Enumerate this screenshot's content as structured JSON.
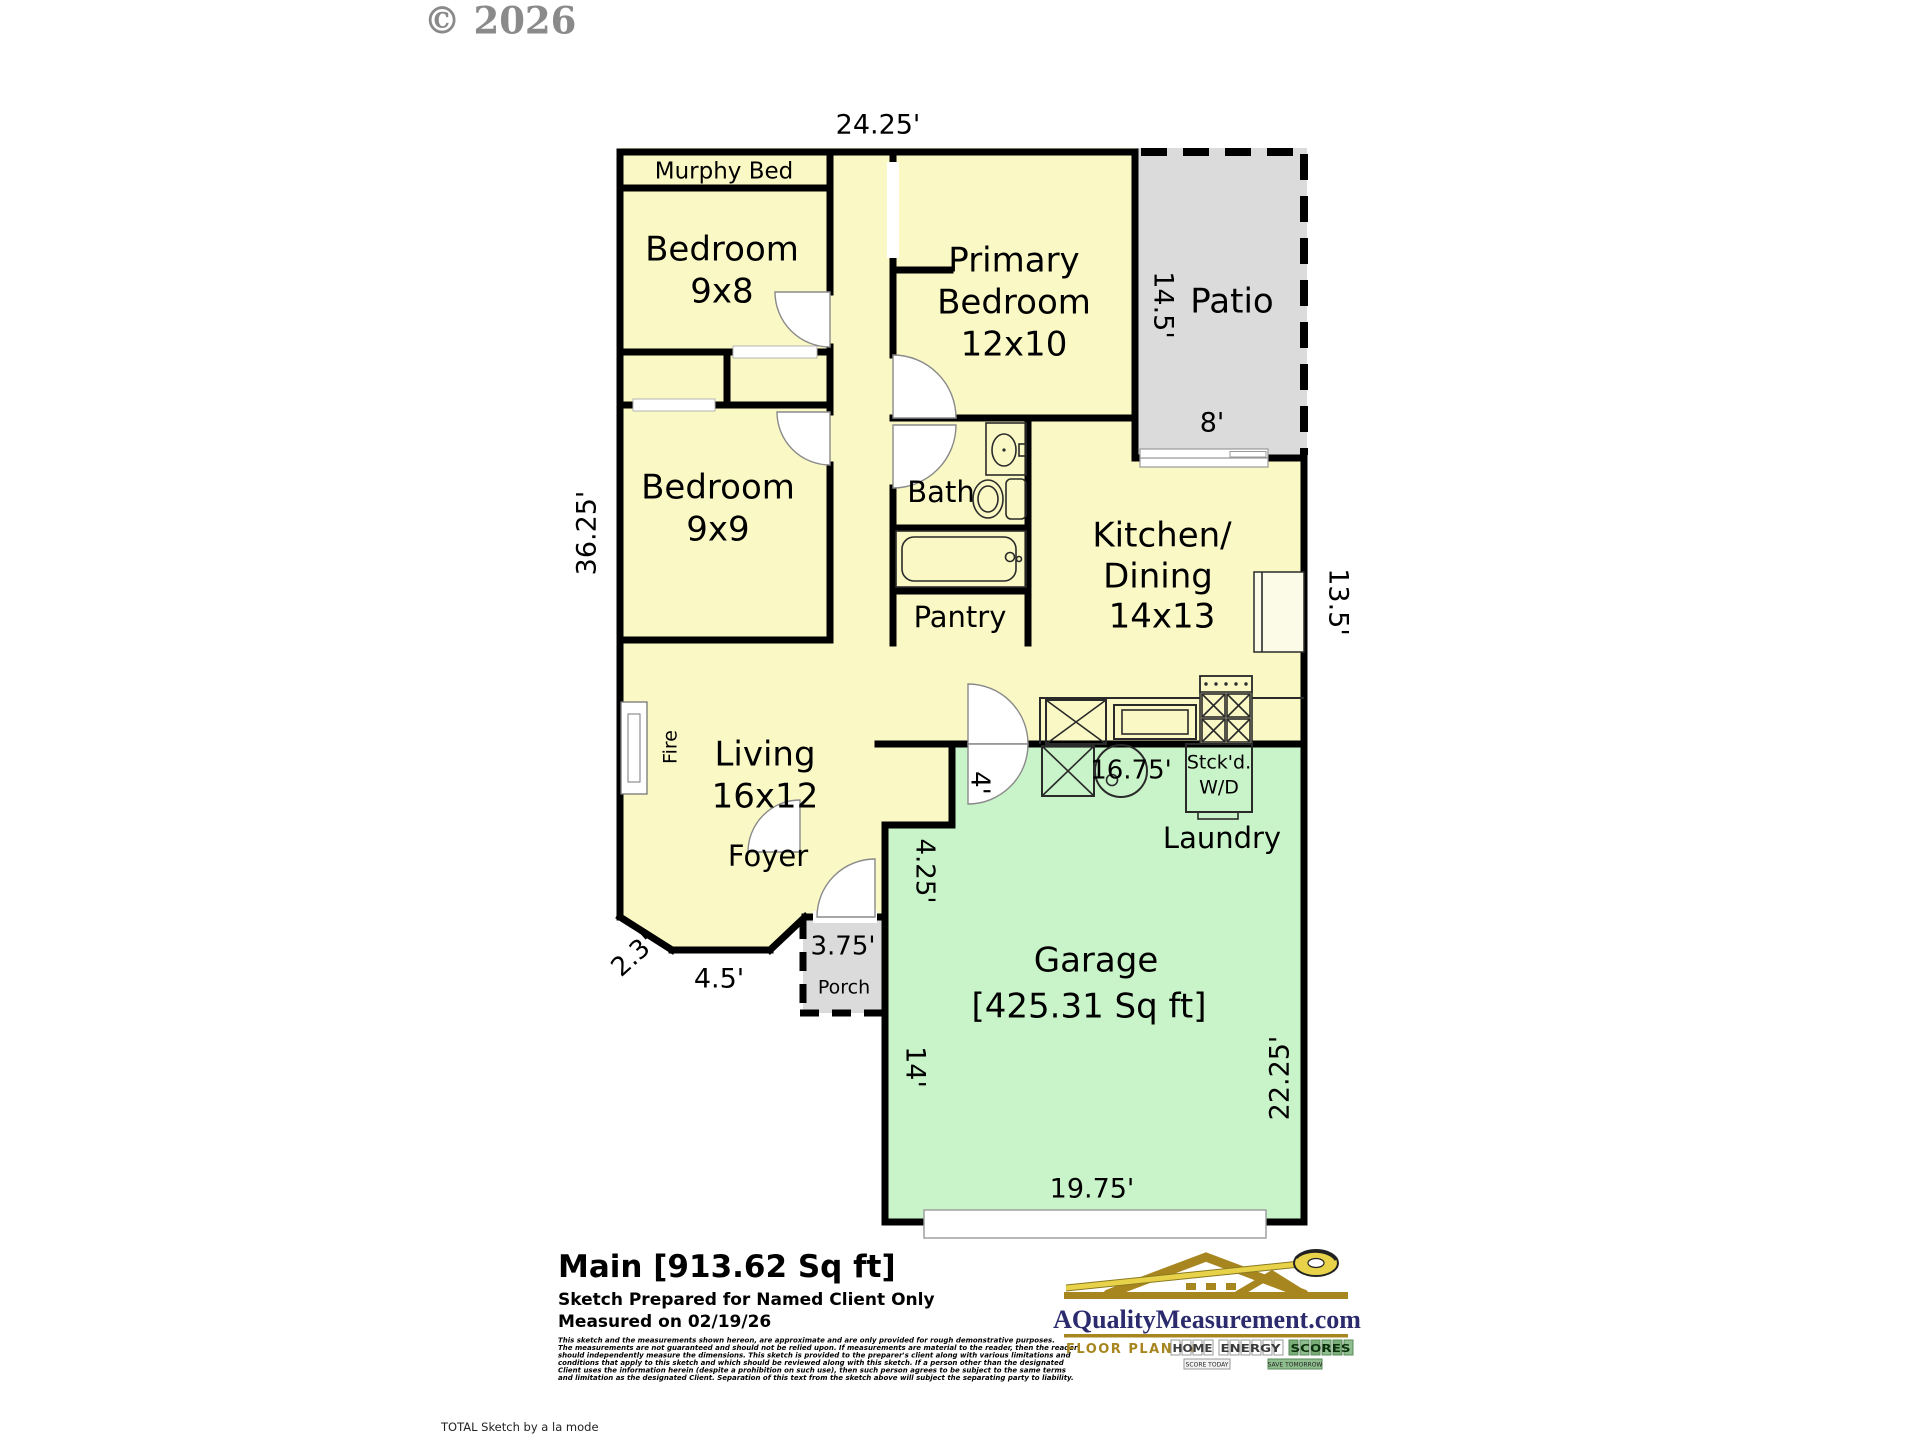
{
  "copyright": "© 2026",
  "colors": {
    "room_fill": "#FAF9C5",
    "garage_fill": "#C9F3C8",
    "outdoor_fill": "#DBDBDB",
    "wall": "#000000",
    "logo_gold": "#A8861F",
    "logo_navy": "#2B2B6E",
    "logo_green": "#79AE79",
    "tape_yellow": "#E8D24A"
  },
  "plan": {
    "rooms": {
      "murphy": "Murphy Bed",
      "bedroom2_name": "Bedroom",
      "bedroom2_size": "9x8",
      "primary_line1": "Primary",
      "primary_line2": "Bedroom",
      "primary_size": "12x10",
      "patio": "Patio",
      "bedroom3_name": "Bedroom",
      "bedroom3_size": "9x9",
      "bath": "Bath",
      "pantry": "Pantry",
      "kitchen_line1": "Kitchen/",
      "kitchen_line2": "Dining",
      "kitchen_size": "14x13",
      "living_name": "Living",
      "living_size": "16x12",
      "fire": "Fire",
      "foyer": "Foyer",
      "porch": "Porch",
      "laundry": "Laundry",
      "wd_line1": "Stck'd.",
      "wd_line2": "W/D",
      "garage_name": "Garage",
      "garage_area": "[425.31 Sq ft]"
    },
    "dims": {
      "top": "24.25'",
      "left": "36.25'",
      "patio_height": "14.5'",
      "patio_width": "8'",
      "kitchen_side": "13.5'",
      "laundry_width": "16.75'",
      "garage_notch": "4'",
      "garage_upper_left": "4.25'",
      "garage_left": "14'",
      "garage_right": "22.25'",
      "garage_bottom": "19.75'",
      "bay_angled": "2.3'",
      "bay_bottom": "4.5'",
      "porch_width": "3.75'"
    }
  },
  "footer": {
    "title": "Main  [913.62 Sq ft]",
    "prepared": "Sketch Prepared for Named Client Only",
    "measured": "Measured on 02/19/26",
    "disclaimer_lines": [
      "This sketch and the measurements shown hereon, are approximate and are only provided for rough demonstrative purposes.",
      "The measurements are not guaranteed and should not be relied upon.  If measurements are material to the reader, then the reader",
      "should independently measure the dimensions.  This sketch is provided to the preparer's client along with various limitations and",
      "conditions that apply to this sketch and which should be reviewed along with this sketch.  If a person other than the designated",
      "Client uses the information herein (despite a prohibition on such use), then such person agrees to be subject to the same terms",
      "and limitation as the designated Client.  Separation of this text from the sketch above will subject the separating party to liability."
    ],
    "total_sketch": "TOTAL Sketch by a la mode"
  },
  "branding": {
    "site": "AQualityMeasurement.com",
    "tagline_prefix": "FLOOR PLANS &",
    "word1": "HOME",
    "word2": "ENERGY",
    "word3": "SCORES",
    "badge1": "SCORE TODAY",
    "badge2": "SAVE TOMORROW"
  }
}
